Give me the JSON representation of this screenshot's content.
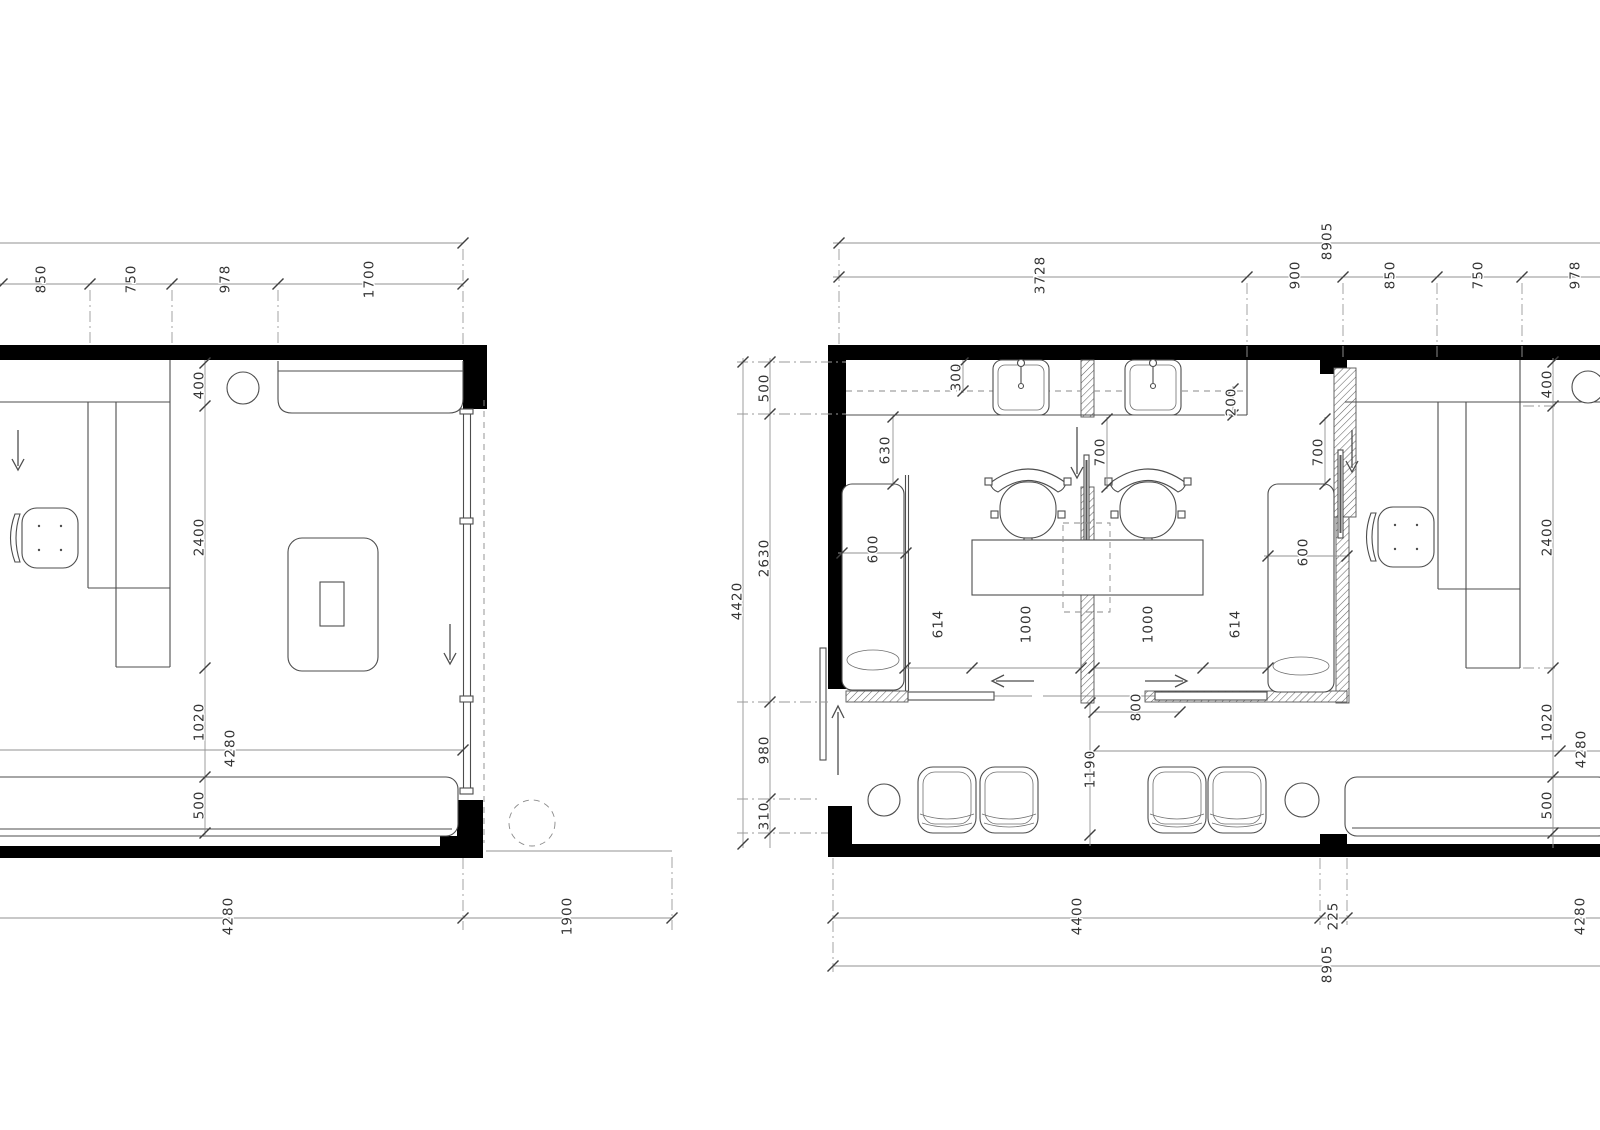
{
  "title": "Architectural floor plans with dimensions",
  "colors": {
    "wall": "#000000",
    "object_line": "#4d4d4d",
    "dimension_line": "#929292",
    "text": "#333333"
  },
  "plan_left": {
    "dim_top": [
      "850",
      "750",
      "978",
      "1700"
    ],
    "dim_side": [
      "400",
      "2400",
      "1020",
      "500"
    ],
    "dim_inner_width": "4280",
    "dim_bottom": [
      "4280",
      "1900"
    ]
  },
  "plan_right": {
    "dim_overall_top": "8905",
    "dim_top": [
      "3728",
      "900",
      "850",
      "750",
      "978"
    ],
    "dim_left_overall": "4420",
    "dim_left": [
      "500",
      "2630",
      "980",
      "310"
    ],
    "dim_right": [
      "400",
      "2400",
      "1020",
      "500"
    ],
    "dim_inner_width": "4280",
    "dim_bottom": [
      "4400",
      "225",
      "4280"
    ],
    "dim_overall_bottom": "8905",
    "dim_counter_depth": "300",
    "dim_counter_end": "200",
    "dim_side_clear": "630",
    "dim_mirror_center": "700",
    "dim_mirror_right": "700",
    "dim_couch_left": "600",
    "dim_couch_right": "600",
    "dim_gap_left": "614",
    "dim_gap_right": "614",
    "dim_station_left": "1000",
    "dim_station_right": "1000",
    "dim_door_clear": "800",
    "dim_waiting_depth": "1190"
  }
}
